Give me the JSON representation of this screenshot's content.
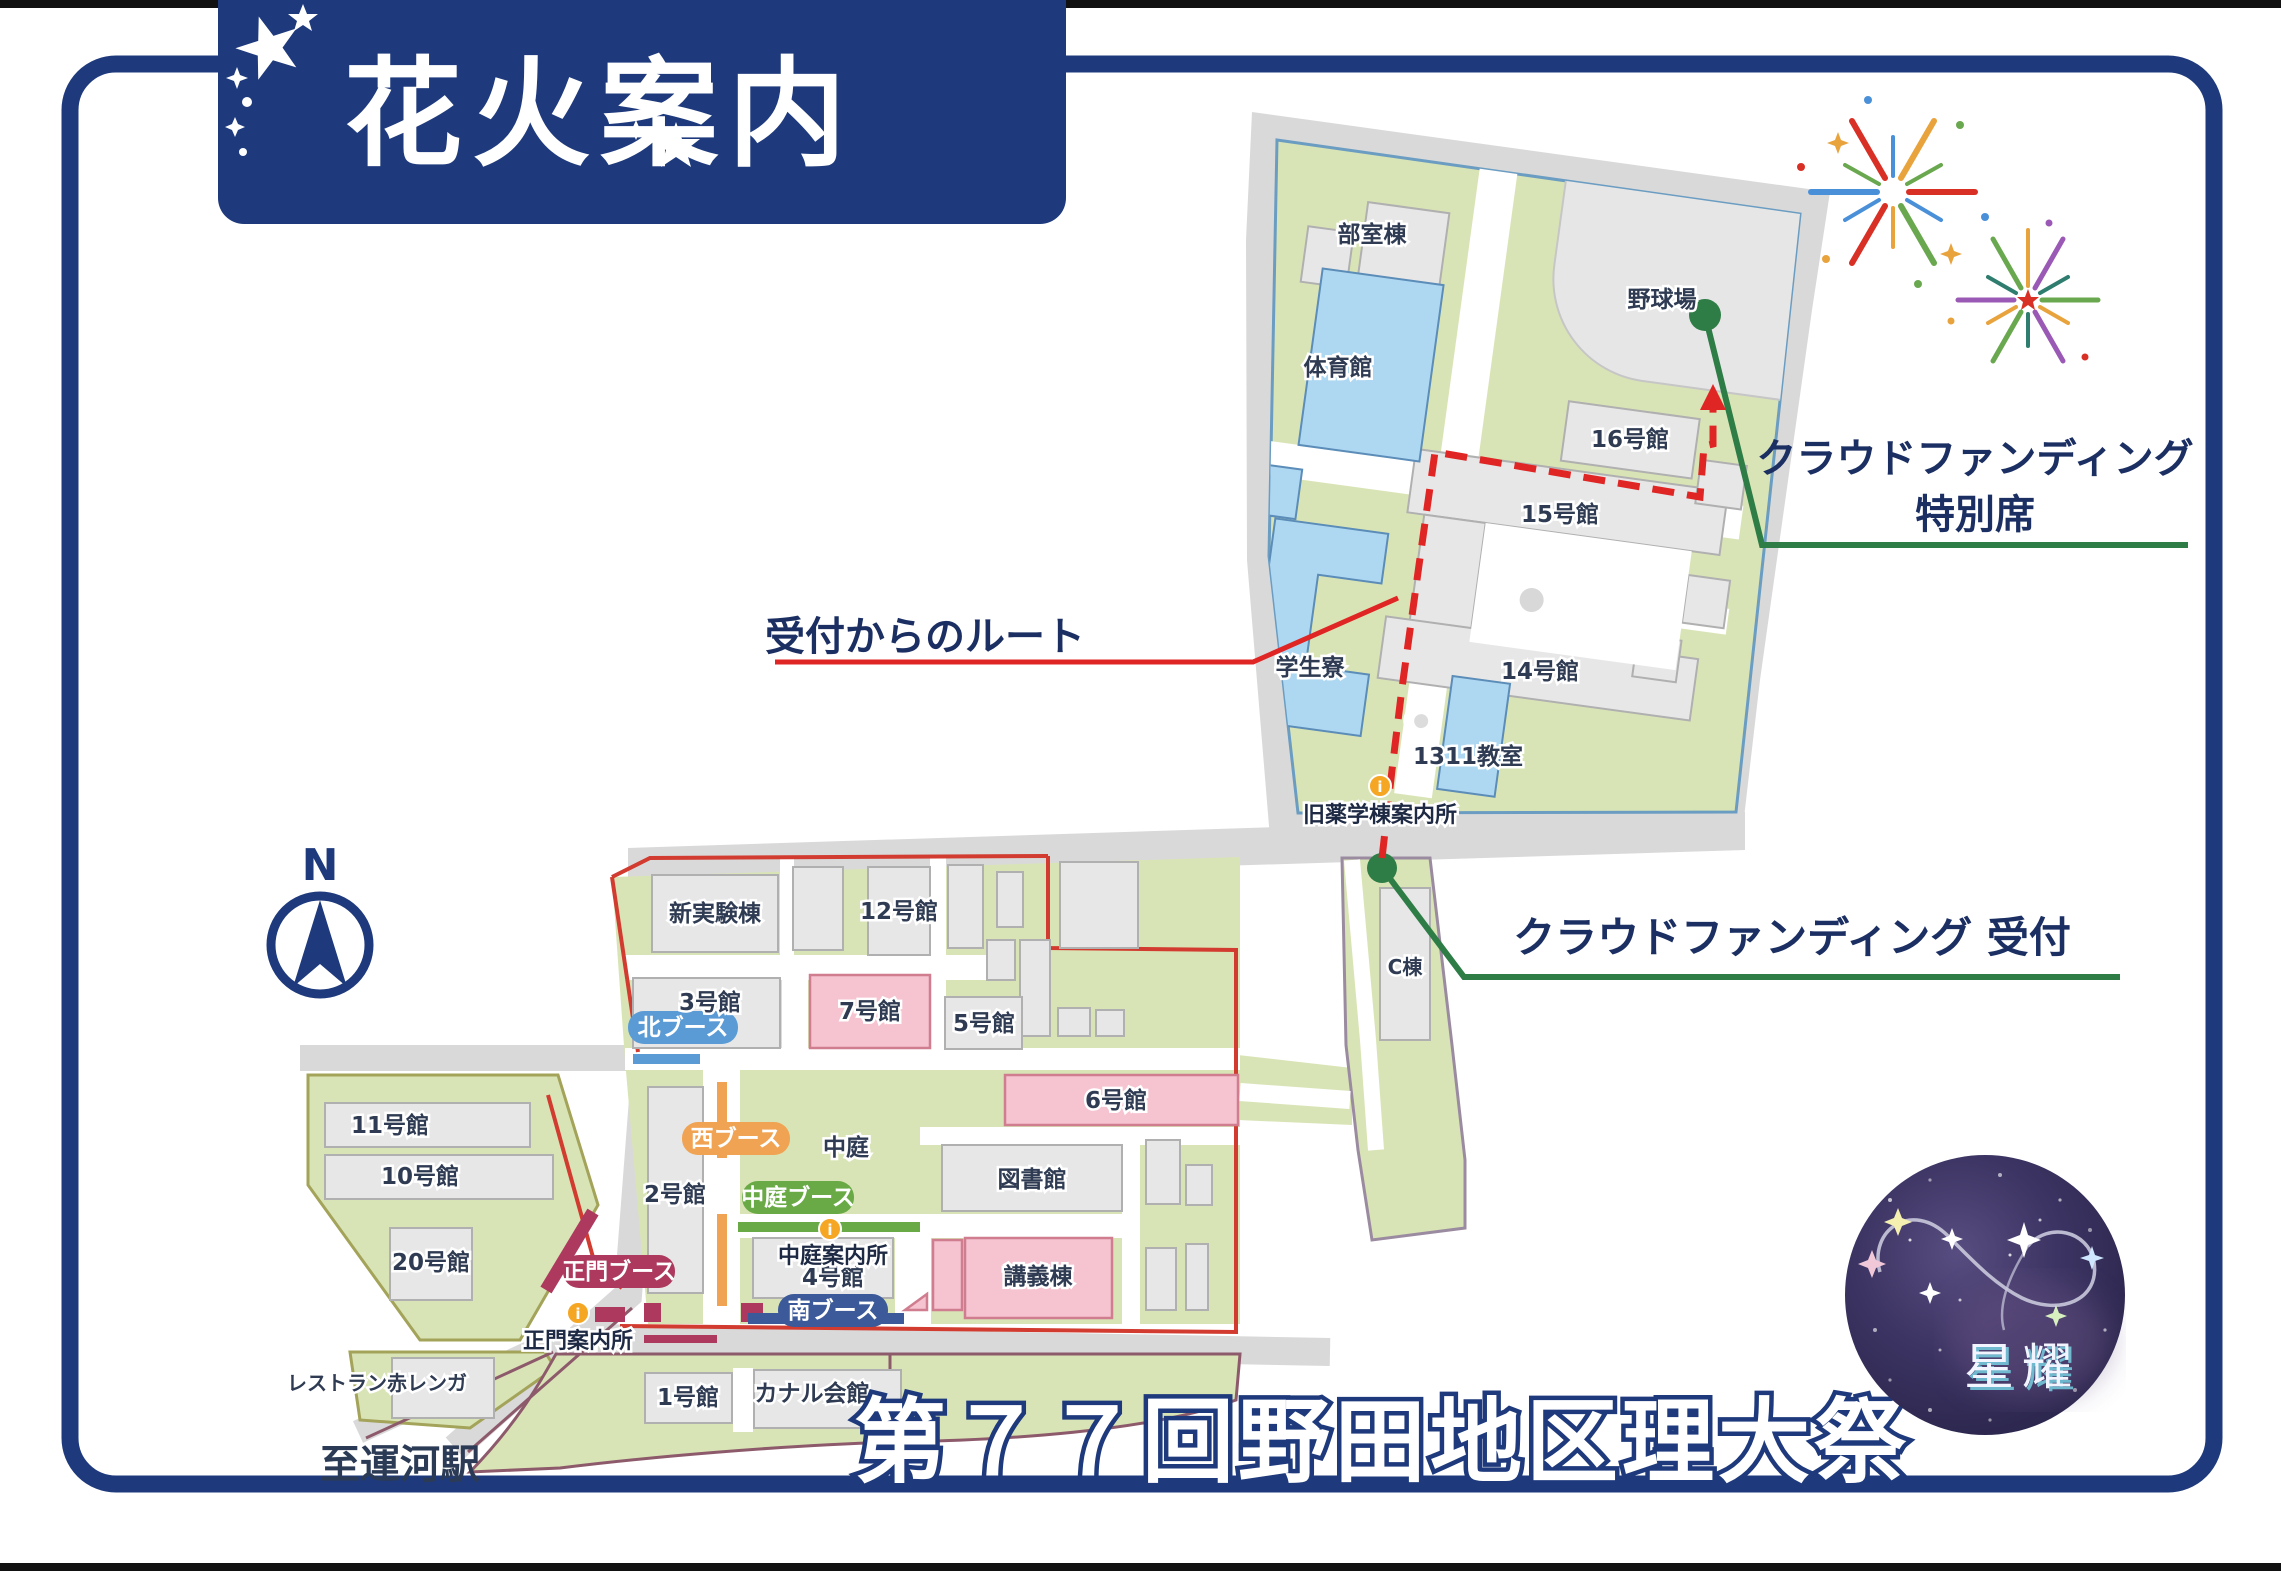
{
  "banner": {
    "title": "花火案内"
  },
  "compass": {
    "label": "N"
  },
  "annotations": {
    "special_seat_line1": "クラウドファンディング",
    "special_seat_line2": "特別席",
    "route_from_reception": "受付からのルート",
    "crowdfunding_reception": "クラウドファンディング 受付",
    "to_station": "至運河駅",
    "festival_title": "第７７回野田地区理大祭"
  },
  "upper_campus": {
    "bushitsu": "部室棟",
    "gym": "体育館",
    "baseball": "野球場",
    "b16": "16号館",
    "b15": "15号館",
    "b14": "14号館",
    "dorm": "学生寮",
    "r1311": "1311教室",
    "old_pharm": "旧薬学棟案内所",
    "c_wing": "C棟"
  },
  "lower_campus": {
    "new_lab": "新実験棟",
    "b12": "12号館",
    "b3": "3号館",
    "b7": "7号館",
    "b5": "5号館",
    "b6": "6号館",
    "b2": "2号館",
    "courtyard": "中庭",
    "library": "図書館",
    "lecture": "講義棟",
    "b4": "4号館",
    "courtyard_info": "中庭案内所",
    "gate_info": "正門案内所",
    "b11": "11号館",
    "b10": "10号館",
    "b20": "20号館",
    "restaurant": "レストラン赤レンガ",
    "b1": "1号館",
    "canal": "カナル会館"
  },
  "booths": {
    "north": "北ブース",
    "west": "西ブース",
    "courtyard": "中庭ブース",
    "south": "南ブース",
    "main_gate": "正門ブース"
  },
  "icons": {
    "info": "i"
  },
  "logo": {
    "name": "星耀"
  },
  "colors": {
    "frame_navy": "#1e3a7c",
    "map_green": "#d9e4b6",
    "road_gray": "#d9d9d9",
    "building_gray": "#e7e7e7",
    "building_blue": "#aed7f2",
    "building_pink": "#f6c3d0",
    "route_red": "#e02525",
    "marker_green": "#2e7d46",
    "booth_north": "#5b9bd5",
    "booth_west": "#f0a353",
    "booth_courtyard": "#6aaa46",
    "booth_south": "#3c5a99",
    "booth_gate": "#ad3a5e",
    "info_orange": "#f5a623"
  }
}
